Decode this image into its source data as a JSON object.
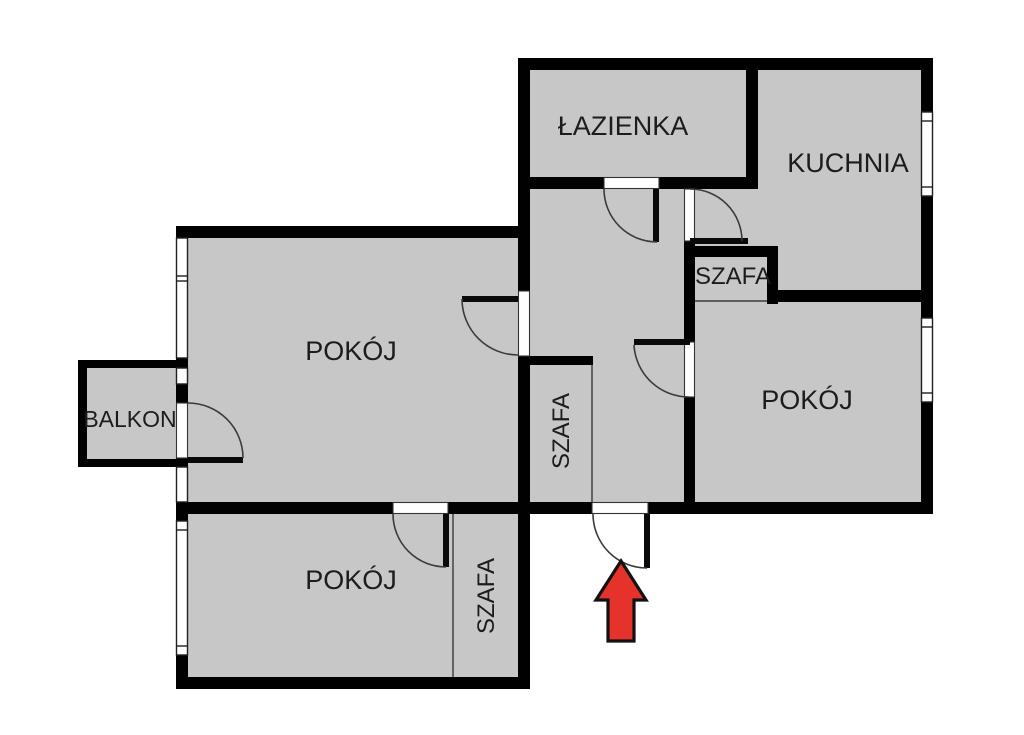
{
  "floorplan": {
    "rooms": [
      {
        "id": "lazienka",
        "label": "ŁAZIENKA"
      },
      {
        "id": "kuchnia",
        "label": "KUCHNIA"
      },
      {
        "id": "szafa-top",
        "label": "SZAFA"
      },
      {
        "id": "pokoj-large",
        "label": "POKÓJ"
      },
      {
        "id": "balkon",
        "label": "BALKON"
      },
      {
        "id": "pokoj-right",
        "label": "POKÓJ"
      },
      {
        "id": "szafa-hall",
        "label": "SZAFA"
      },
      {
        "id": "pokoj-bottom",
        "label": "POKÓJ"
      },
      {
        "id": "szafa-bottom",
        "label": "SZAFA"
      }
    ],
    "entrance_arrow": {
      "direction": "up",
      "color": "#e5332c"
    },
    "colors": {
      "floor": "#c7c7c7",
      "wall": "#010101",
      "label": "#1c1c1c",
      "background": "#ffffff"
    }
  }
}
